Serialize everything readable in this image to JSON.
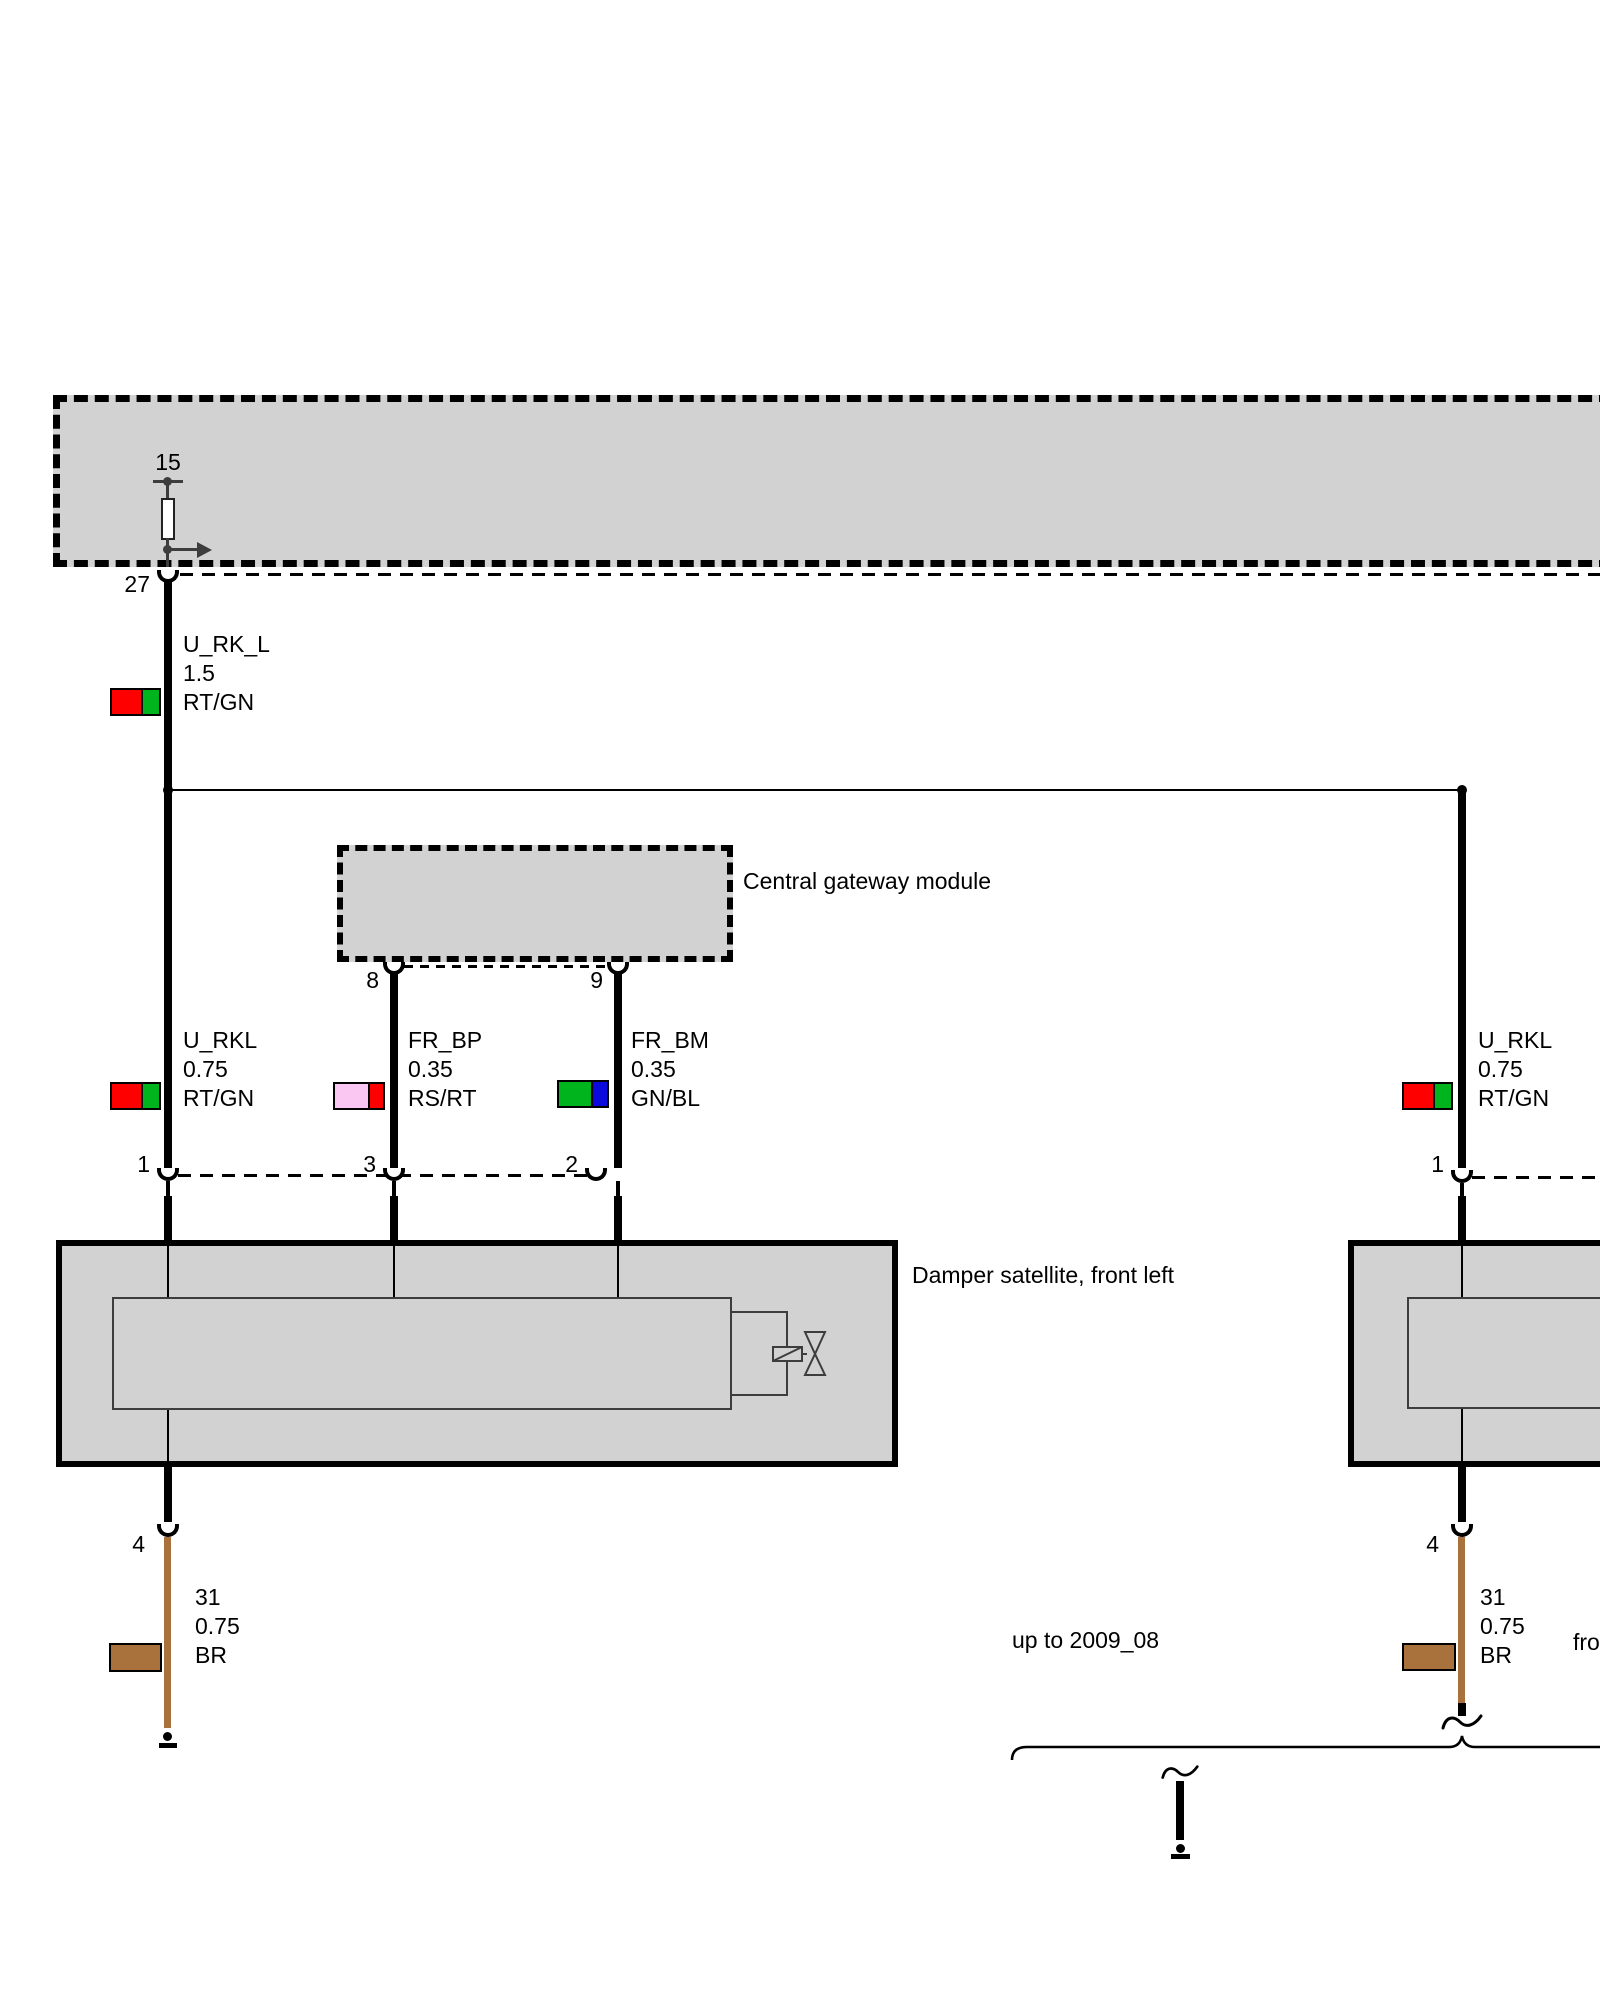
{
  "labels": {
    "central_gateway_module": "Central gateway module",
    "damper_satellite_front_left": "Damper satellite, front left",
    "note_period": "up to 2009_08",
    "note_right_clipped": "fro",
    "terminal_15": "15"
  },
  "pins": {
    "power_out": "27",
    "gateway_a": "8",
    "gateway_b": "9",
    "damper_supply": "1",
    "damper_bp": "3",
    "damper_bm": "2",
    "damper_ground": "4",
    "damper_right_supply": "1",
    "damper_right_ground": "4"
  },
  "wire_labels": [
    {
      "name": "U_RK_L",
      "gauge": "1.5",
      "code": "RT/GN"
    },
    {
      "name": "U_RKL",
      "gauge": "0.75",
      "code": "RT/GN"
    },
    {
      "name": "FR_BP",
      "gauge": "0.35",
      "code": "RS/RT"
    },
    {
      "name": "FR_BM",
      "gauge": "0.35",
      "code": "GN/BL"
    },
    {
      "name": "U_RKL",
      "gauge": "0.75",
      "code": "RT/GN"
    },
    {
      "name": "31",
      "gauge": "0.75",
      "code": "BR"
    },
    {
      "name": "31",
      "gauge": "0.75",
      "code": "BR"
    }
  ],
  "colors": {
    "box_fill": "#d2d2d2",
    "wire_black": "#000000",
    "wire_brown": "#a9713c",
    "swatch_red": "#fe0000",
    "swatch_green": "#00b41e",
    "swatch_pink": "#f9c7f2",
    "swatch_blue": "#0a0adc",
    "swatch_brown": "#a9713c",
    "terminal_gray": "#3d3d3d"
  }
}
